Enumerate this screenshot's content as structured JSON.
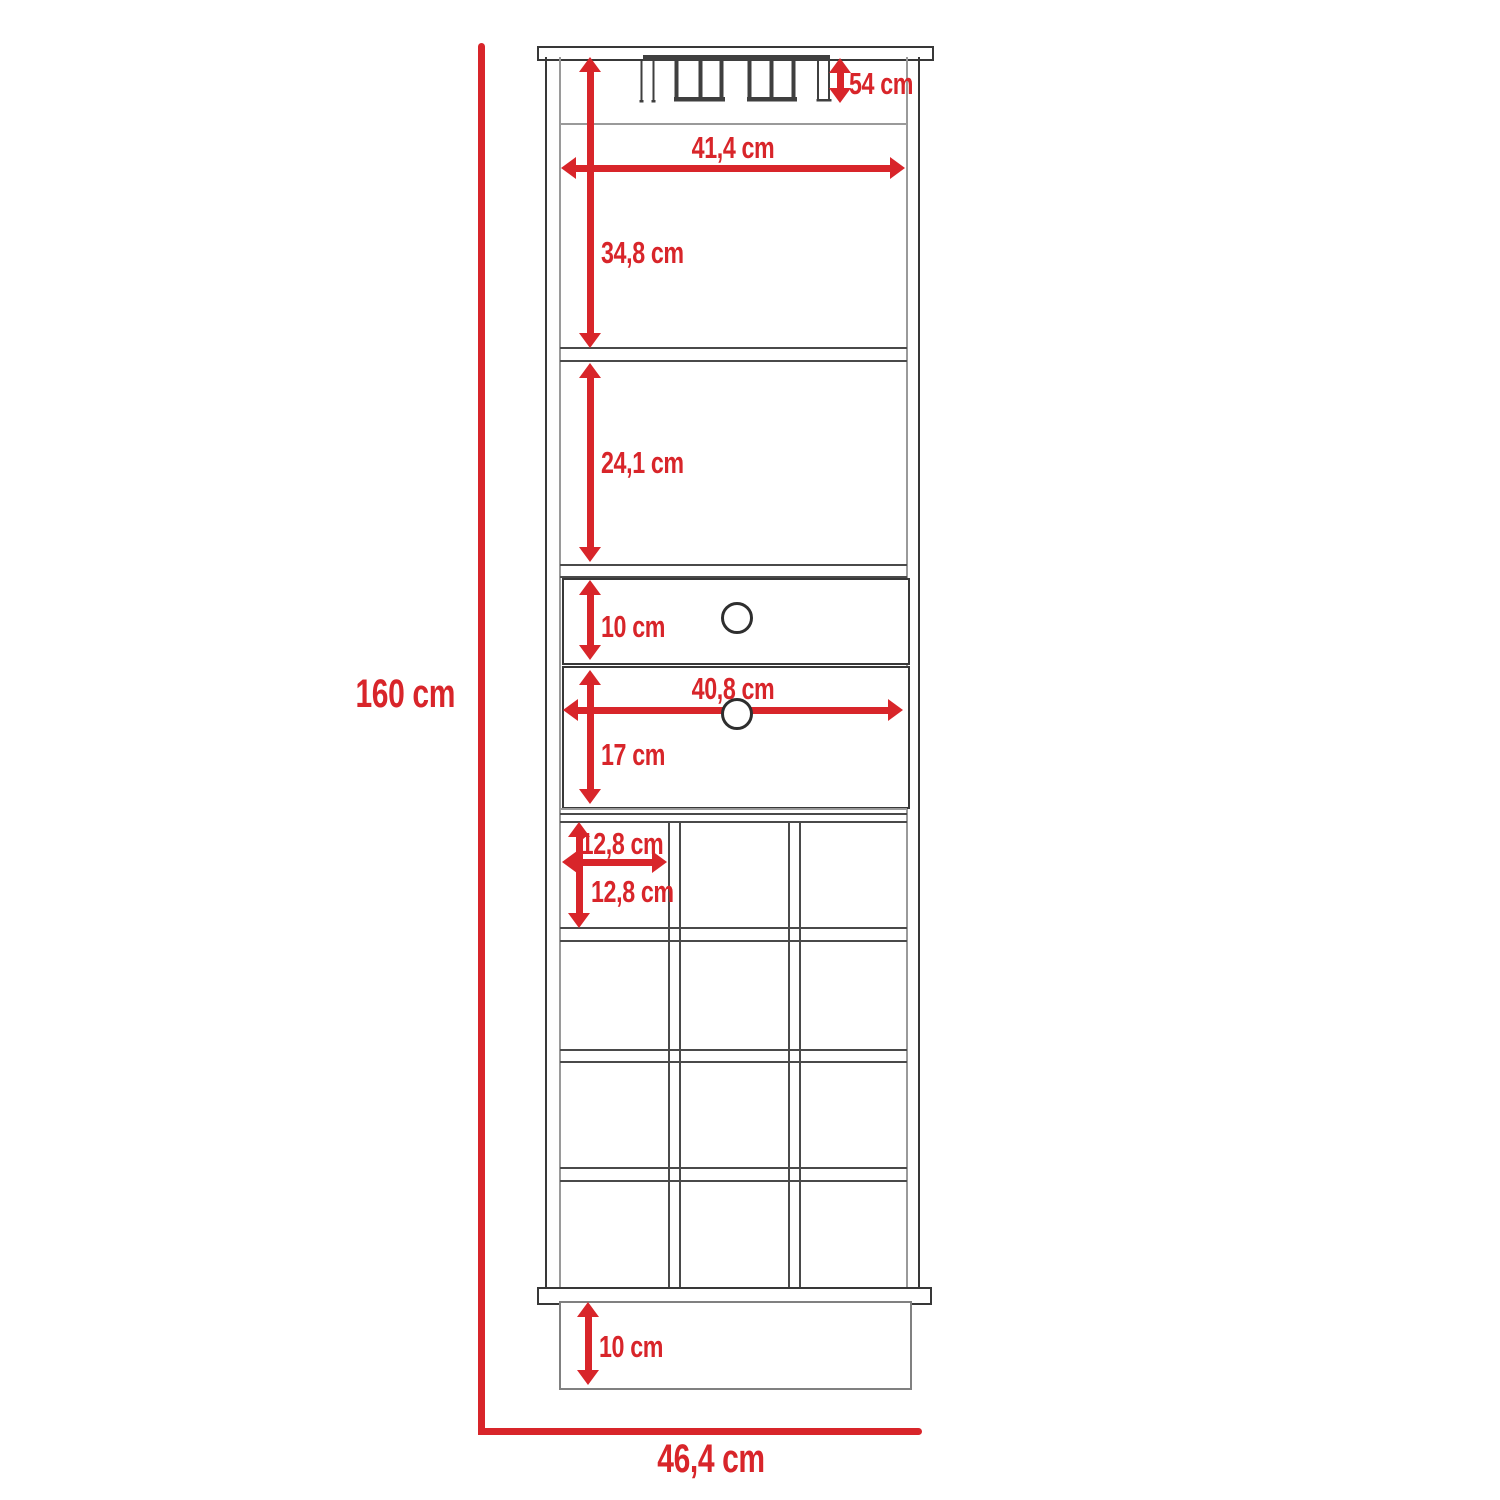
{
  "diagram": {
    "type": "furniture-dimension-drawing",
    "subject": "tall bar cabinet with stemware rack, two shelves, two drawers and 12 wine cubbies",
    "unit": "cm",
    "colors": {
      "dimension_red": "#d8252a",
      "outline_dark": "#383838",
      "outline_gray": "#9a9a9a",
      "background": "#ffffff"
    }
  },
  "dimensions": {
    "total_height": {
      "label": "160 cm"
    },
    "total_width": {
      "label": "46,4 cm"
    },
    "stemware_rack_height": {
      "label": "54 cm"
    },
    "upper_interior_width": {
      "label": "41,4 cm"
    },
    "upper_shelf_height": {
      "label": "34,8 cm"
    },
    "middle_shelf_height": {
      "label": "24,1 cm"
    },
    "top_drawer_height": {
      "label": "10 cm"
    },
    "drawer_width": {
      "label": "40,8 cm"
    },
    "bottom_drawer_height": {
      "label": "17 cm"
    },
    "wine_cubby_width": {
      "label": "12,8 cm"
    },
    "wine_cubby_height": {
      "label": "12,8 cm"
    },
    "base_height": {
      "label": "10 cm"
    }
  }
}
